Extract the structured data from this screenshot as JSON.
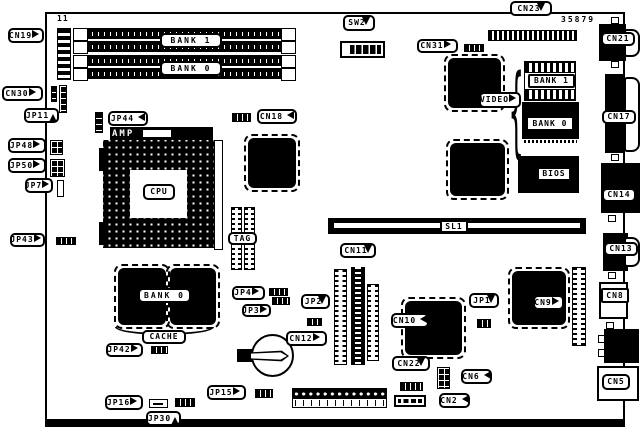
{
  "diagram": {
    "part_number": "35879",
    "ref_11": "11"
  },
  "callouts": {
    "cn19": "CN19",
    "cn30": "CN30",
    "jp11": "JP11",
    "jp48": "JP48",
    "jp50": "JP50",
    "jp7": "JP7",
    "jp43": "JP43",
    "jp44": "JP44",
    "cn18": "CN18",
    "sw2": "SW2",
    "cn31": "CN31",
    "cn23": "CN23",
    "cn21": "CN21",
    "cn17": "CN17",
    "cn14": "CN14",
    "cn13": "CN13",
    "cn8": "CN8",
    "cn5": "CN5",
    "cn11": "CN11",
    "cn12": "CN12",
    "cn10": "CN10",
    "cn9": "CN9",
    "jp1": "JP1",
    "jp2": "JP2",
    "jp3": "JP3",
    "jp4": "JP4",
    "jp42": "JP42",
    "jp15": "JP15",
    "jp16": "JP16",
    "jp30": "JP30",
    "cn22": "CN22",
    "cn6": "CN6",
    "cn2": "CN2",
    "sl1": "SL1"
  },
  "components": {
    "dimm_bank1": "BANK 1",
    "dimm_bank0": "BANK 0",
    "cpu": "CPU",
    "amp": "AMP",
    "tag": "TAG",
    "cache_bank0": "BANK 0",
    "cache": "CACHE",
    "video": "VIDEO",
    "video_bank1": "BANK 1",
    "video_bank0": "BANK 0",
    "bios": "BIOS"
  }
}
